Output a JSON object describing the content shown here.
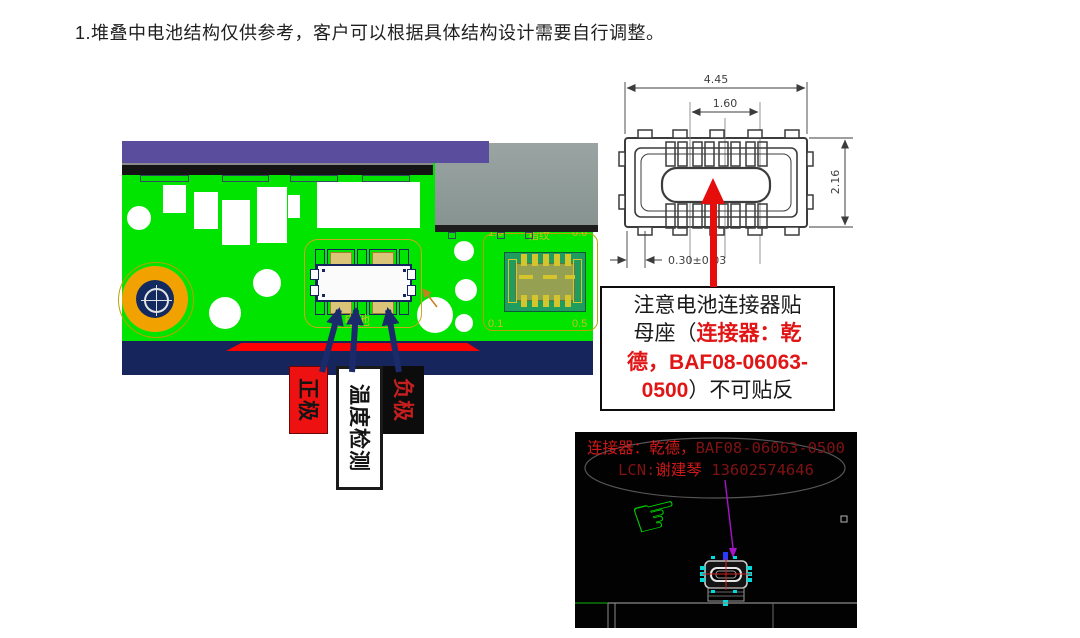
{
  "heading": "1.堆叠中电池结构仅供参考，客户可以根据具体结构设计需要自行调整。",
  "colors": {
    "pcb-green": "#00e400",
    "board-purple": "#5a4d9e",
    "battery-gray": "#94a09e",
    "navy": "#16265c",
    "strip-red": "#ff0000",
    "pad-orange": "#f2a200",
    "pad-tan": "#d9c478",
    "arrow-navy": "#1b2a6b",
    "callout-red": "#e11515",
    "cad-red-bright": "#d01818",
    "cad-red-dim": "#801212",
    "hand-green": "#00cf00",
    "magenta": "#a812c8",
    "cyan": "#00dcdc",
    "silk-yellow": "#c9bb2a"
  },
  "pcb": {
    "silkscreen": {
      "fp_top_left": "1.0",
      "fp_top_center": "指纹",
      "fp_top_right": "0.6",
      "fp_bottom_left": "0.1",
      "fp_bottom_right": "0.5",
      "battery_area": "电池"
    },
    "pin_labels": [
      {
        "id": "positive",
        "text": "正极",
        "bg": "#ee1111",
        "fg": "#141414",
        "border": "#6a0808"
      },
      {
        "id": "temp-sense",
        "text": "温度检测",
        "bg": "#ffffff",
        "fg": "#141414",
        "border": "#1a1a1a"
      },
      {
        "id": "negative",
        "text": "负极",
        "bg": "#0c0c0c",
        "fg": "#c41f1f",
        "border": "#0c0c0c"
      }
    ]
  },
  "drawing": {
    "dim_width": "4.45",
    "dim_pitch": "1.60",
    "dim_height": "2.16",
    "dim_offset": "0.30±0.03"
  },
  "callout": {
    "lines": [
      [
        {
          "t": "注意电池连接器贴",
          "red": false
        }
      ],
      [
        {
          "t": "母座（",
          "red": false
        },
        {
          "t": "连接器：乾",
          "red": true
        }
      ],
      [
        {
          "t": "德，BAF08-06063-",
          "red": true
        }
      ],
      [
        {
          "t": "0500",
          "red": true
        },
        {
          "t": "）不可贴反",
          "red": false
        }
      ]
    ]
  },
  "cad": {
    "lines": [
      [
        {
          "t": "连接器：乾德，",
          "c": "#d01818"
        },
        {
          "t": "BAF08-06063-0500",
          "c": "#801212"
        }
      ],
      [
        {
          "t": "LCN:",
          "c": "#801212"
        },
        {
          "t": "谢建琴",
          "c": "#d01818"
        },
        {
          "t": " 13602574646",
          "c": "#801212"
        }
      ]
    ]
  },
  "icons": {
    "pointing_hand": "☞"
  }
}
